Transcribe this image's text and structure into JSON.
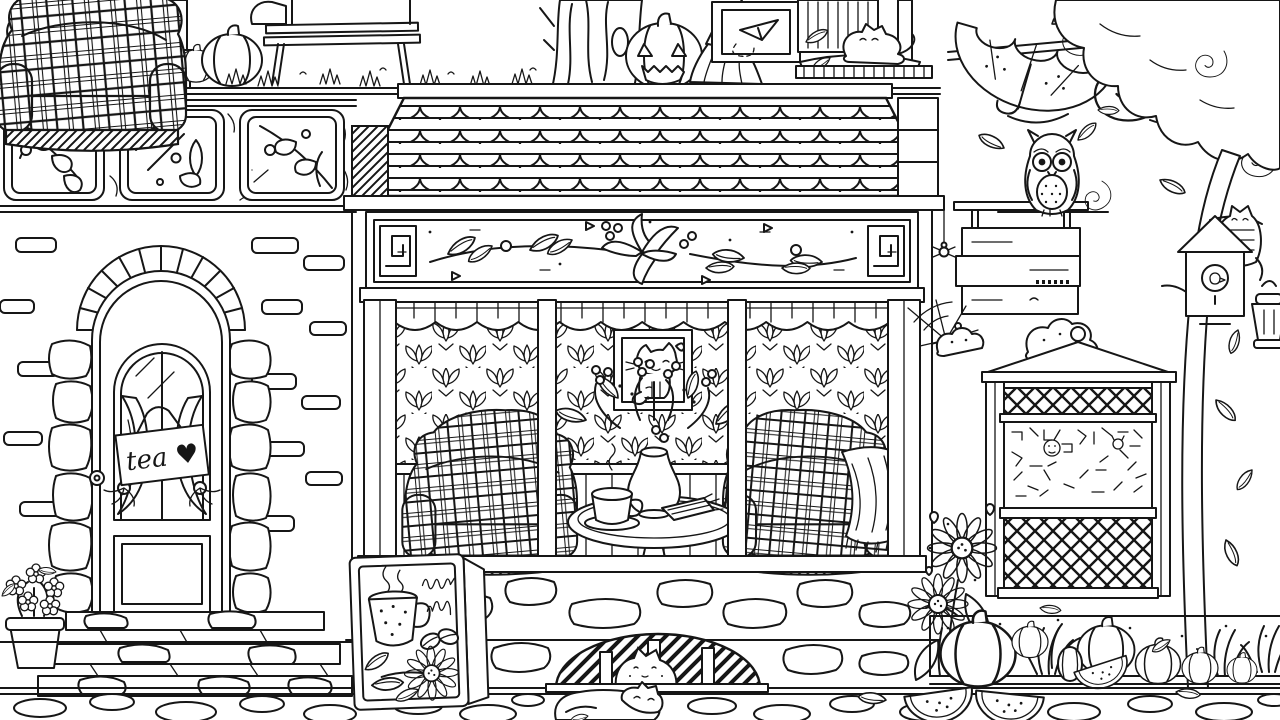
{
  "scene": {
    "style": "black-and-white coloring-book line art",
    "setting": "autumn street cafe with stone house, cats and pumpkins",
    "palette": {
      "line": "#161616",
      "background": "#ffffff"
    },
    "door": {
      "sign_text": "tea ♥"
    },
    "depicted_objects": [
      "porch-house",
      "bench-with-cat",
      "pumpkins",
      "tree-trunk",
      "jack-o-lantern",
      "broom",
      "framed-paper-plane-picture",
      "cat-sleeping-on-sill",
      "upside-down-umbrella",
      "wind-swirls",
      "falling-leaves",
      "owl-on-branch",
      "tiled-frieze-windows",
      "brick-wall",
      "arched-door-with-tea-sign",
      "stone-steps",
      "flower-pot",
      "cafe-scalloped-roof",
      "floral-frieze",
      "storefront-window",
      "valance-curtain",
      "fleur-wallpaper",
      "cat-portrait",
      "plaid-armchairs",
      "blanket",
      "round-table",
      "teacup",
      "flower-vase",
      "napkin",
      "hanging-blank-sign",
      "spiders-and-web",
      "garden-kiosk",
      "doodle-panel",
      "lattice-panels",
      "sunflowers",
      "pumpkin-patch",
      "melon-slices",
      "tree-with-birdhouse",
      "cat-in-tree",
      "lantern",
      "drain-cat",
      "sleeping-cat",
      "cobblestones",
      "a-frame-coffee-signboard"
    ]
  }
}
